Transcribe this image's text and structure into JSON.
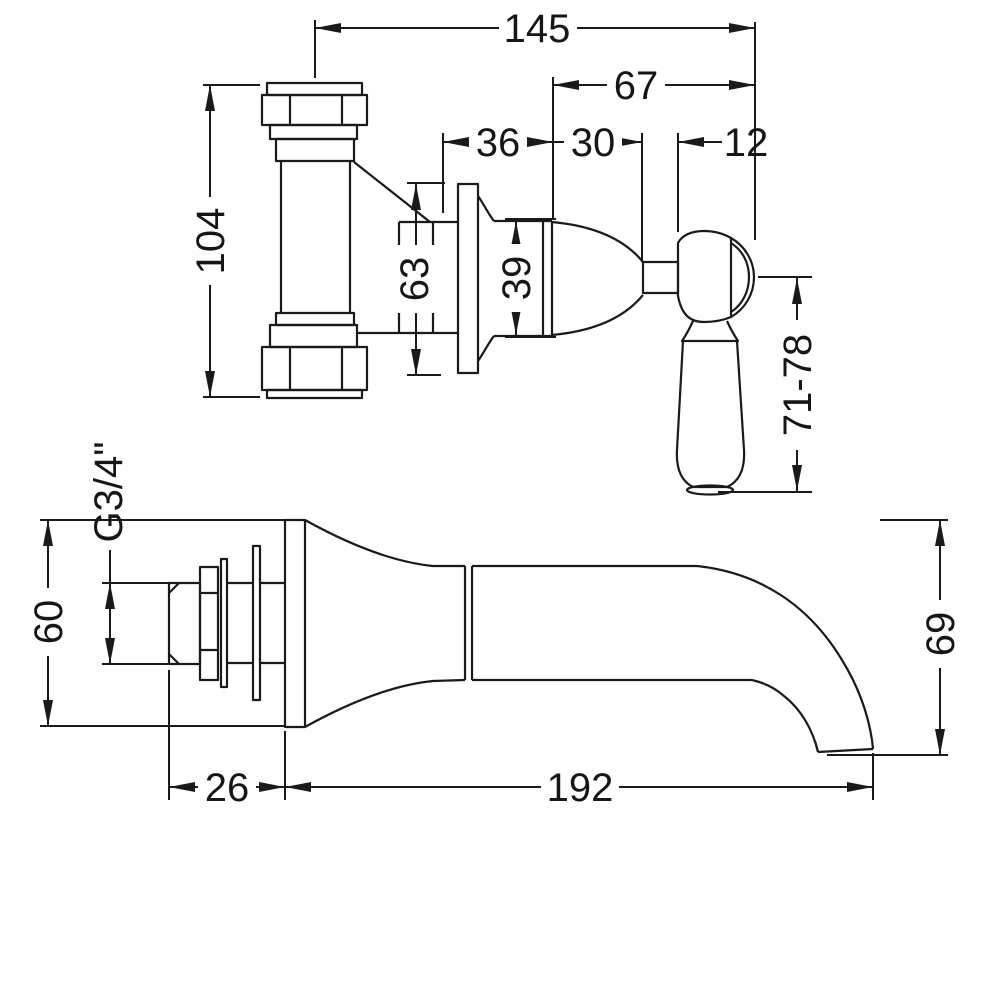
{
  "background": "#ffffff",
  "ink": "#1a1a1a",
  "views": {
    "valve": {
      "dims": {
        "overall_width": "145",
        "handle_offset": "67",
        "trim_depth": "36",
        "cartridge_depth": "30",
        "stem_width": "12",
        "tee_height": "104",
        "flange_diameter": "63",
        "body_diameter": "39",
        "lever_length": "71-78"
      }
    },
    "spout": {
      "dims": {
        "inlet_height": "60",
        "thread_size": "G3/4\"",
        "wall_depth": "26",
        "reach": "192",
        "drop": "69"
      }
    }
  }
}
